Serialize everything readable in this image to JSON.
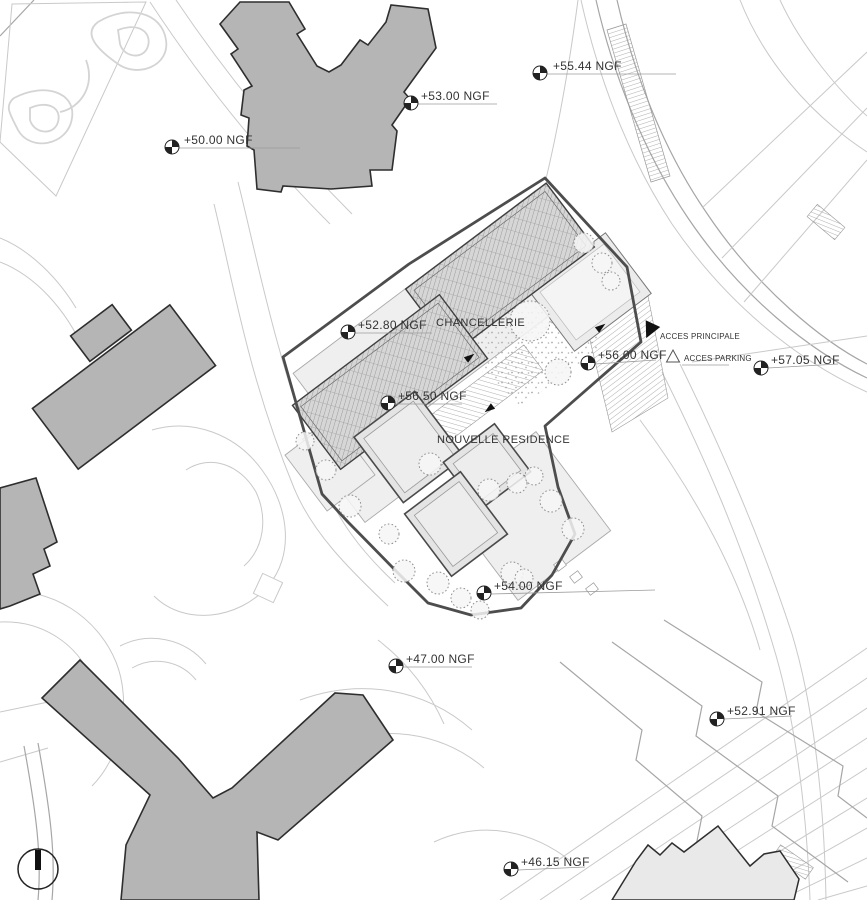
{
  "labels": {
    "chancellerie": "CHANCELLERIE",
    "nouvelle_residence": "NOUVELLE RESIDENCE",
    "acces_principale": "ACCES PRINCIPALE",
    "acces_parking": "ACCES PARKING"
  },
  "elevations": [
    {
      "id": "ngf-55-44",
      "text": "+55.44 NGF"
    },
    {
      "id": "ngf-53-00",
      "text": "+53.00 NGF"
    },
    {
      "id": "ngf-50-00",
      "text": "+50.00 NGF"
    },
    {
      "id": "ngf-52-80",
      "text": "+52.80 NGF"
    },
    {
      "id": "ngf-56-00",
      "text": "+56.00 NGF"
    },
    {
      "id": "ngf-57-05",
      "text": "+57.05 NGF"
    },
    {
      "id": "ngf-56-50",
      "text": "+56.50 NGF"
    },
    {
      "id": "ngf-54-00",
      "text": "+54.00 NGF"
    },
    {
      "id": "ngf-47-00",
      "text": "+47.00 NGF"
    },
    {
      "id": "ngf-52-91",
      "text": "+52.91 NGF"
    },
    {
      "id": "ngf-46-15",
      "text": "+46.15 NGF"
    }
  ],
  "symbols": {
    "benchmark": "survey-benchmark-quadrant-circle",
    "north_indicator": "circle-with-black-needle",
    "acces_principale_marker": "filled-triangle",
    "acces_parking_marker": "open-triangle"
  },
  "colors": {
    "background": "#ffffff",
    "building_fill": "#b5b5b5",
    "building_outline": "#2e2e2e",
    "light_building_fill": "#e9e9e9",
    "site_boundary": "#4d4d4d",
    "roof_hatch": "#8c8c8c",
    "contour_line": "#c9c9c9",
    "road_line": "#a6a6a6",
    "label_text": "#333333"
  }
}
